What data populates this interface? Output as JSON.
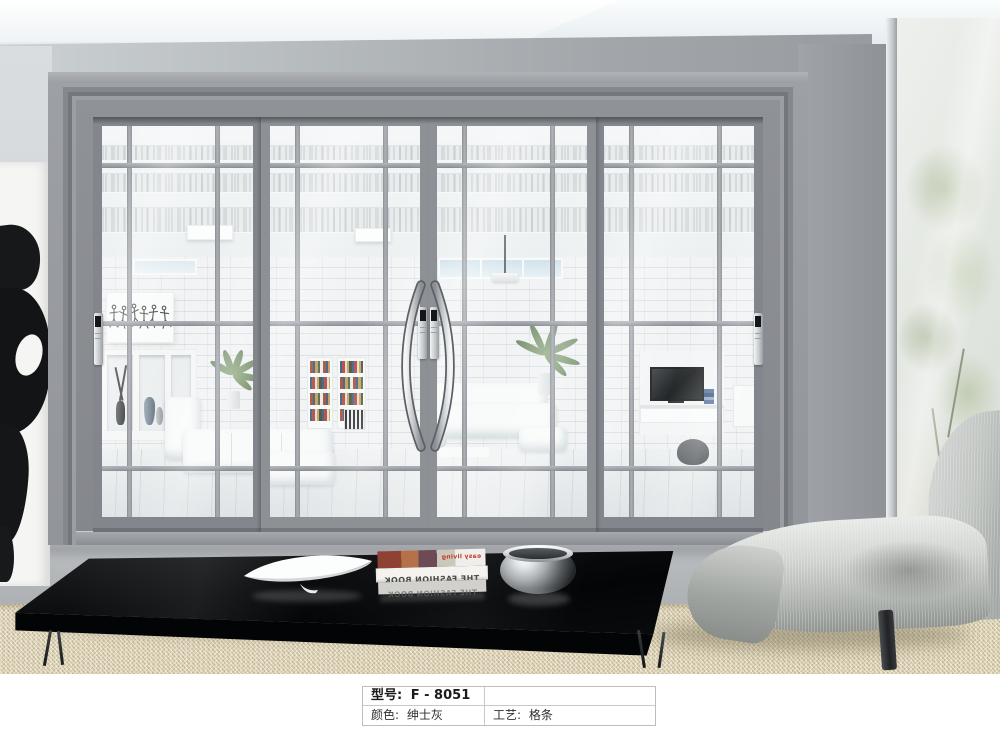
{
  "spec_table": {
    "rows": [
      {
        "label": "型号:",
        "value": "F - 8051"
      },
      {
        "label": "颜色:",
        "value": "绅士灰"
      },
      {
        "label": "工艺:",
        "value": "格条"
      }
    ]
  },
  "decor": {
    "magazine_spine_1": "THE FASHION BOOK",
    "magazine_spine_2": "THE FASHION BOOK",
    "magazine_cover_text": "easy living"
  },
  "colors": {
    "door_frame_gray": "#8f9297",
    "door_sash_front": "#8d9095",
    "door_sash_back": "#83868c",
    "muntin_gray": "#9ea1a6",
    "wall_right_gray": "#9b9fa3",
    "wall_left_light": "#d5d9dc",
    "carpet_beige": "#d7cbad",
    "table_black": "#0a0b0d",
    "chair_fabric": "#c2c5c2",
    "handle_chrome": "#d9dcde"
  }
}
